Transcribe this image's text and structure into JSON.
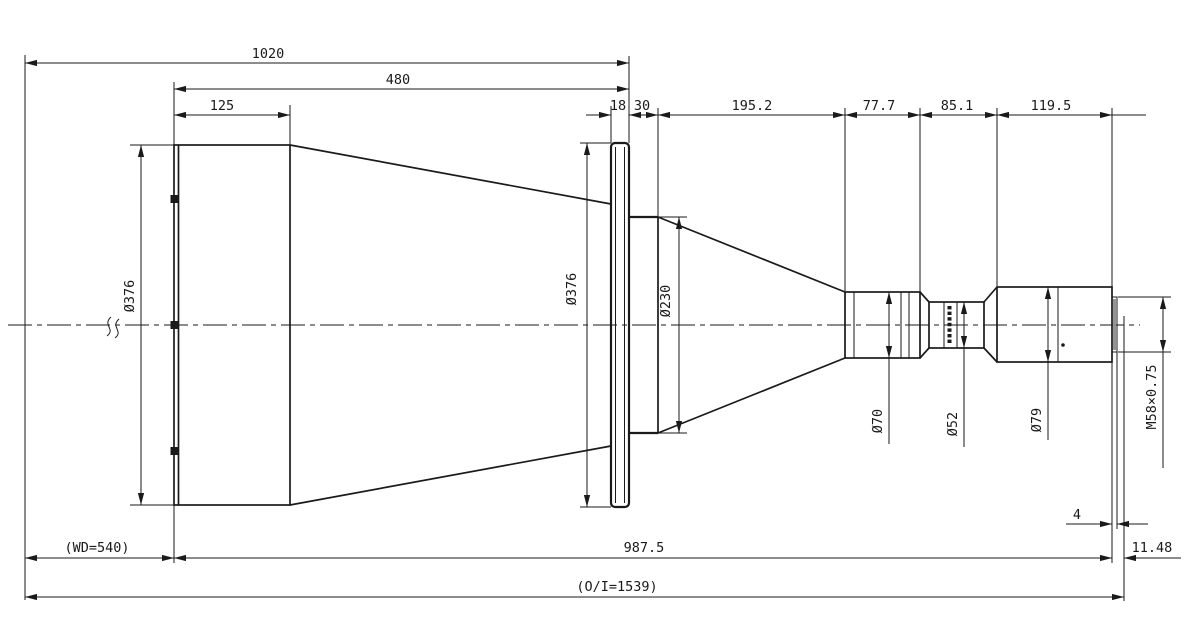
{
  "drawing": {
    "top_dims": {
      "overall_front": "1020",
      "hood_length": "480",
      "front_cell": "125"
    },
    "chain_dims": {
      "flange_thickness": "18",
      "rear_cell": "30",
      "rear_cone": "195.2",
      "section_70": "77.7",
      "section_52": "85.1",
      "section_79": "119.5"
    },
    "dia_labels": {
      "front_diameter": "Ø376",
      "flange_diameter": "Ø376",
      "rear_cell_diameter": "Ø230",
      "barrel_70": "Ø70",
      "barrel_52": "Ø52",
      "barrel_79": "Ø79"
    },
    "thread_spec": "M58×0.75",
    "bottom_dims": {
      "working_distance": "(WD=540)",
      "body_length": "987.5",
      "thread_length": "4",
      "flange_focal": "11.48",
      "object_image": "(O/I=1539)"
    },
    "colors": {
      "ink": "#1a1a1a",
      "background": "#ffffff",
      "thread_gray": "#949494"
    }
  }
}
